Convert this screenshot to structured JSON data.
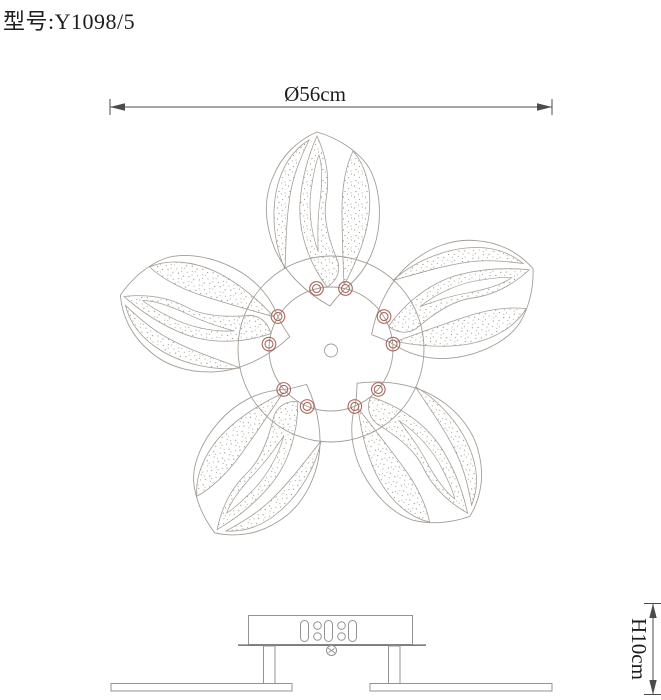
{
  "title": "型号:Y1098/5",
  "dimensions": {
    "diameter": "Ø56cm",
    "height": "H10cm"
  },
  "drawing": {
    "petal_count": 5,
    "screws_per_petal": 2
  },
  "colors": {
    "background": "#ffffff",
    "line": "#a39d96",
    "side_view_line": "#959391",
    "dimension_line": "#4b4b4b",
    "text": "#1d1d1d",
    "screw_accent": "#a5685e",
    "stipple": "#968e86"
  }
}
